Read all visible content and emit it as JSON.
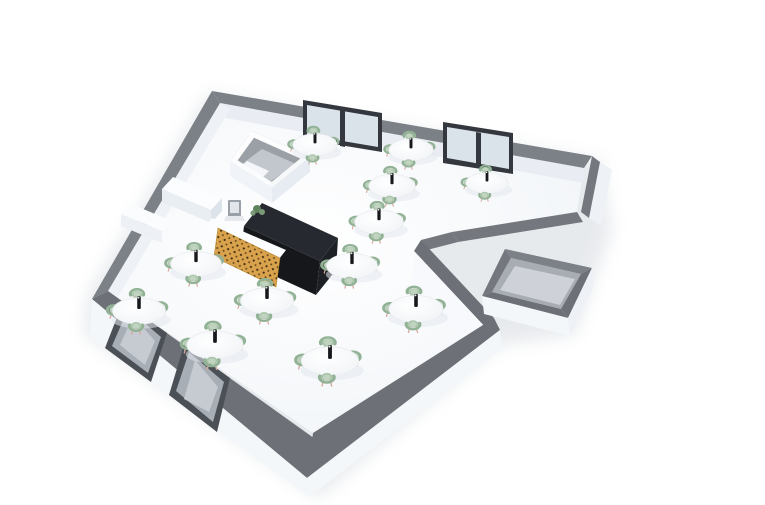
{
  "scene": {
    "title": "3D floor plan render of a cafe dining room",
    "view": "isometric perspective cutaway",
    "background_color": "#ffffff"
  },
  "palette": {
    "wall_top_far": "#7c8187",
    "wall_top_mid": "#74787e",
    "wall_top_near": "#6d7177",
    "wall_interior_face": "#e9edf3",
    "wall_side_face": "#eef2f7",
    "wall_exterior_face": "#f4f7fa",
    "wall_exterior_bright": "#f7f9fc",
    "floor_center": "#ffffff",
    "floor_edge": "#eff3f7",
    "window_frame": "#34383e",
    "window_glass": "#dae2ea",
    "door_frame": "#4b5056",
    "door_panel": "#a8aeb5",
    "door_glass": "#c6cbd1",
    "storage_wall_inner": "#a8adb4",
    "storage_floor": "#ced2d8",
    "enclosure_wall": "#9aa0a6",
    "enclosure_floor": "#c2c7cd",
    "counter_white": "#fbfdfe",
    "counter_white_front": "#e9eef3",
    "counter_black_top": "#26292f",
    "counter_black_front": "#15171b",
    "bar_panel_wood": "#d9a24c",
    "bar_panel_dot_dark": "#3a2b10",
    "bar_panel_dot_mid": "#6b4a1a",
    "chair_seat": "#abc5ac",
    "chair_seat_light": "#c3d6c2",
    "chair_back": "#92b295",
    "chair_leg": "#d8a89f",
    "table_edge": "#e9ecf0",
    "table_shadow": "#e3e8ee",
    "pedestal": "#d3d8de",
    "bottle": "#17181c",
    "bottle_cap": "#e8e8ea",
    "register_body": "#9aa0a7",
    "register_screen": "#e2e6eb",
    "plant_dark": "#61845f",
    "plant_light": "#7a9a77",
    "building_shadow": "#ccd1d8"
  },
  "furniture": {
    "tables": [
      {
        "id": 1,
        "x": 315,
        "y": 145,
        "s": 0.82,
        "chairs": [
          "n",
          "w",
          "e",
          "s"
        ]
      },
      {
        "id": 2,
        "x": 411,
        "y": 150,
        "s": 0.82,
        "chairs": [
          "n",
          "w",
          "e",
          "s"
        ]
      },
      {
        "id": 3,
        "x": 392,
        "y": 186,
        "s": 0.86,
        "chairs": [
          "n",
          "w",
          "e",
          "s"
        ]
      },
      {
        "id": 4,
        "x": 487,
        "y": 183,
        "s": 0.78,
        "chairs": [
          "n",
          "w",
          "s"
        ]
      },
      {
        "id": 5,
        "x": 379,
        "y": 222,
        "s": 0.9,
        "chairs": [
          "n",
          "w",
          "e",
          "s"
        ]
      },
      {
        "id": 6,
        "x": 196,
        "y": 264,
        "s": 0.94,
        "chairs": [
          "n",
          "w",
          "e",
          "s"
        ]
      },
      {
        "id": 7,
        "x": 352,
        "y": 266,
        "s": 0.94,
        "chairs": [
          "n",
          "w",
          "e",
          "s"
        ]
      },
      {
        "id": 8,
        "x": 267,
        "y": 301,
        "s": 0.98,
        "chairs": [
          "n",
          "w",
          "e",
          "s"
        ]
      },
      {
        "id": 9,
        "x": 139,
        "y": 311,
        "s": 0.98,
        "chairs": [
          "n",
          "w",
          "e",
          "s"
        ]
      },
      {
        "id": 10,
        "x": 416,
        "y": 309,
        "s": 1.0,
        "chairs": [
          "n",
          "w",
          "e",
          "s"
        ]
      },
      {
        "id": 11,
        "x": 215,
        "y": 345,
        "s": 1.04,
        "chairs": [
          "n",
          "w",
          "e",
          "s"
        ]
      },
      {
        "id": 12,
        "x": 330,
        "y": 361,
        "s": 1.06,
        "chairs": [
          "n",
          "w",
          "e",
          "s"
        ]
      }
    ],
    "bar": {
      "wood_lattice_front": true,
      "black_l_counter": true,
      "white_counter_top": true,
      "register": true,
      "plant": true,
      "back_counter": true,
      "side_table": true
    },
    "kitchen_pass_enclosure": true,
    "storage_room": true,
    "corridor_wing": true
  },
  "openings": {
    "window_units": [
      {
        "wall": "north",
        "panes": 2
      },
      {
        "wall": "north",
        "panes": 2
      }
    ],
    "doors": [
      {
        "wall": "south",
        "type": "glass"
      },
      {
        "wall": "south",
        "type": "glass"
      }
    ]
  }
}
